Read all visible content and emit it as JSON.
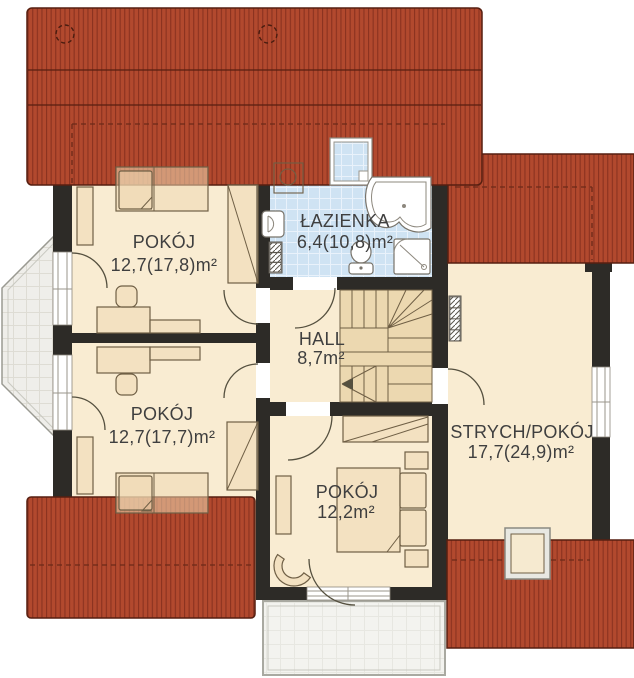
{
  "plan": {
    "type": "floor-plan-attic-storey",
    "rooms": [
      {
        "name": "POKÓJ",
        "area": "12,7(17,8)m²"
      },
      {
        "name": "ŁAZIENKA",
        "area": "6,4(10,8)m²"
      },
      {
        "name": "HALL",
        "area": "8,7m²"
      },
      {
        "name": "POKÓJ",
        "area": "12,7(17,7)m²"
      },
      {
        "name": "POKÓJ",
        "area": "12,2m²"
      },
      {
        "name": "STRYCH/POKÓJ",
        "area": "17,7(24,9)m²"
      }
    ],
    "colors": {
      "roof": "#b2492e",
      "roof_stripe": "#8a3220",
      "roof_outline": "#571f10",
      "wall": "#2d2b27",
      "floor": "#f9ecd2",
      "furniture": "#eed9b2",
      "tile": "#cfe3f3",
      "glass": "#efeeea",
      "text": "#3f3f3f"
    }
  }
}
